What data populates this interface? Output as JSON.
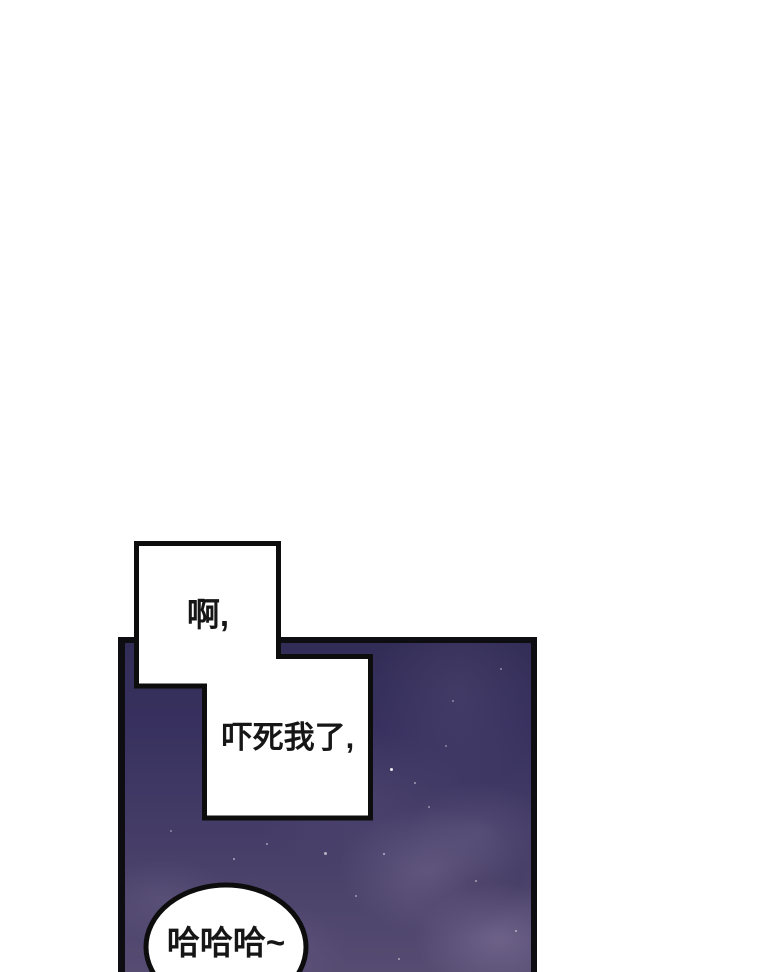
{
  "page": {
    "kind": "webtoon-comic-panel",
    "background": "#ffffff"
  },
  "panel": {
    "colors": {
      "frame": "#0e0d12",
      "sky_top": "#322d57",
      "sky_middle": "#413a65",
      "sky_bottom": "#564c72",
      "cloud": "#7d7198",
      "star": "#ffffff",
      "bubble_fill": "#ffffff",
      "bubble_stroke": "#0d0d0d",
      "text": "#161616"
    }
  },
  "speech_bubbles": [
    {
      "id": "bubble-ah",
      "text": "啊,"
    },
    {
      "id": "bubble-scared",
      "text": "吓死我了,"
    },
    {
      "id": "bubble-haha",
      "text": "哈哈哈~"
    }
  ]
}
